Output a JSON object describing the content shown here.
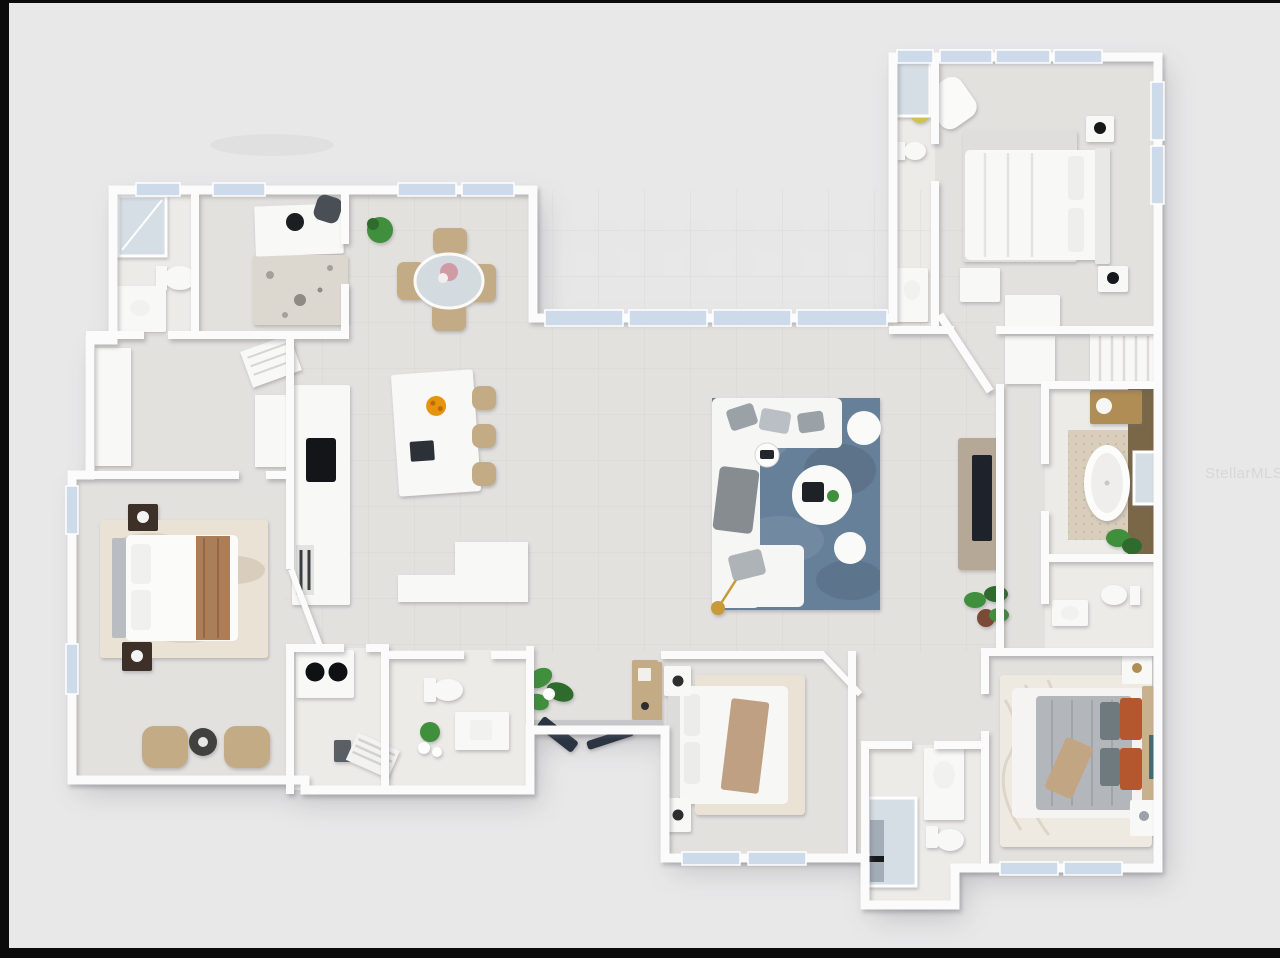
{
  "image_type": "3d-rendered-top-down-floor-plan",
  "watermark": {
    "text": "StellarMLS"
  },
  "palette": {
    "bg": "#e8e8e9",
    "frame": "#0b0b0b",
    "wall": "#fbfbfb",
    "floor": "#e3e1de",
    "floor-tile": "#d9d7d4",
    "bath-floor": "#edebe7",
    "window": "#ccdae9",
    "glass": "#d5dee4",
    "rug-blue": "#66809a",
    "rug-blue-light": "#8398ac",
    "rug-blue-dark": "#53687b",
    "rug-cream": "#e9e2d5",
    "rug-shag": "#efeae1",
    "rug-speckle": "#dcd8d0",
    "sofa": "#f6f6f5",
    "pillow-gray": "#9aa1a7",
    "wood": "#b08d55",
    "tan": "#c3ab85",
    "wood-dark": "#3c3028",
    "brown-runner": "#ab7e5a",
    "accent-wall": "#7a6747",
    "plant": "#3f8f3d",
    "plant-dark": "#2e6b2c",
    "dark": "#23272e",
    "navy": "#2b3442",
    "orange": "#e8930f",
    "rust": "#b4572f",
    "duvet": "#b3b6bb",
    "teal-art": "#3e6f74",
    "gold": "#c79a3a",
    "tile-mosaic": "#d9cdbc",
    "watermark": "#d7d7d9"
  },
  "rooms": [
    {
      "name": "office-den",
      "items": [
        "desk",
        "desk-chair",
        "monitor",
        "speckled-rug",
        "potted-plant"
      ]
    },
    {
      "name": "bathroom-top-left",
      "items": [
        "shower",
        "toilet",
        "vanity"
      ]
    },
    {
      "name": "walk-in-closet",
      "items": [
        "wardrobe-units",
        "slatted-shelves"
      ]
    },
    {
      "name": "dining-area",
      "items": [
        "round-glass-table",
        "four-tan-chairs",
        "floral-centerpiece",
        "potted-plant"
      ]
    },
    {
      "name": "kitchen",
      "items": [
        "counter-run",
        "black-cooktop",
        "refrigerator",
        "island",
        "island-sink",
        "orange-fruit-bowl",
        "three-bar-stools",
        "peninsula-counter"
      ]
    },
    {
      "name": "great-room",
      "items": [
        "white-sectional-sofa",
        "gray-pillows",
        "blue-marbled-rug",
        "round-coffee-table",
        "two-white-ottomans",
        "side-table",
        "gold-floor-lamp",
        "tv-media-unit",
        "potted-plants"
      ]
    },
    {
      "name": "foyer",
      "items": [
        "large-plant",
        "wood-console-table",
        "dark-double-entry-doors",
        "threshold"
      ]
    },
    {
      "name": "master-bedroom",
      "items": [
        "bed-with-gray-headboard",
        "brown-throw-runner",
        "cream-marbled-rug",
        "two-dark-nightstands",
        "lamps",
        "two-tan-armchairs",
        "round-dark-side-table"
      ]
    },
    {
      "name": "laundry-room",
      "items": [
        "stacked-washer-dryer",
        "drying-rack",
        "utility-sink"
      ]
    },
    {
      "name": "powder-room",
      "items": [
        "toilet",
        "vanity",
        "plant"
      ]
    },
    {
      "name": "middle-bedroom",
      "items": [
        "bed-white-bedding",
        "tan-throw",
        "cream-rug",
        "two-nightstands-with-lamps",
        "closet-door"
      ]
    },
    {
      "name": "shared-bathroom",
      "items": [
        "glass-shower",
        "toilet",
        "vanity"
      ]
    },
    {
      "name": "right-bedroom",
      "items": [
        "bed-gray-duvet",
        "rust-pillows",
        "tan-headboard",
        "shag-rug",
        "two-nightstands",
        "teal-wall-art"
      ]
    },
    {
      "name": "guest-suite-bedroom",
      "items": [
        "bed-white",
        "headboard",
        "two-nightstands-black-lamps",
        "armchair",
        "yellow-side-table",
        "gray-rug",
        "closet-dressers"
      ]
    },
    {
      "name": "guest-suite-bathroom",
      "items": [
        "shower",
        "toilet",
        "vanity"
      ]
    },
    {
      "name": "master-bathroom",
      "items": [
        "freestanding-tub",
        "mosaic-tile-floor",
        "wood-vanity",
        "glass-shower",
        "brown-accent-wall",
        "plant"
      ]
    },
    {
      "name": "water-closet",
      "items": [
        "toilet",
        "sink"
      ]
    },
    {
      "name": "hall-closets",
      "items": [
        "white-wardrobes"
      ]
    }
  ]
}
